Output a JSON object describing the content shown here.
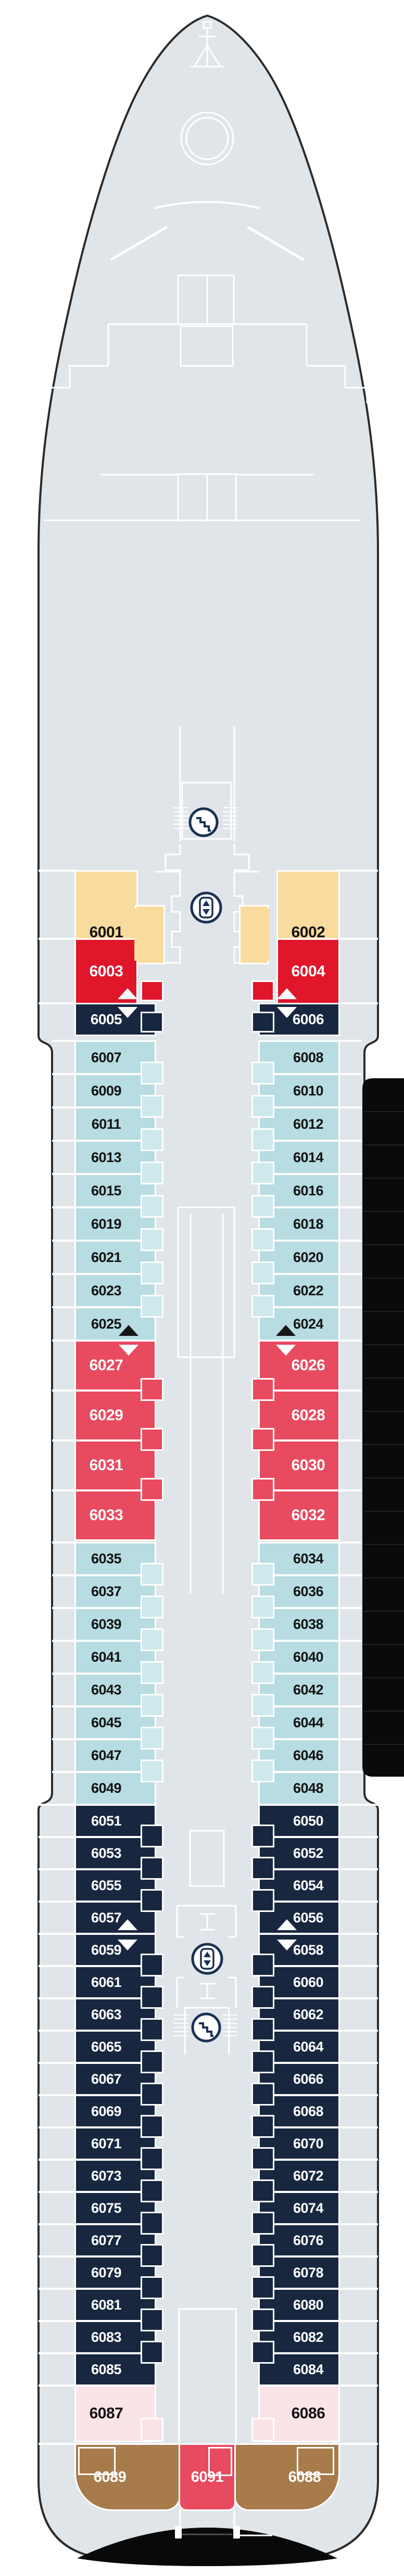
{
  "deck_plan_name": "cruise-ship-deck-plan",
  "colors": {
    "background": "#ffffff",
    "deck": "#e0e5e9",
    "hull_outline": "#2b2b2b",
    "line_art": "#ffffff",
    "lifeboat_band": "#0a0a0a",
    "lifeboat_band_line": "#212121",
    "stern_bulwark": "#090909",
    "icon_navy": "#1b3054",
    "arrow_black": "#161616",
    "arrow_white": "#ffffff"
  },
  "cabin_categories": {
    "yellow": {
      "fill": "#f8db9d",
      "text": "#121212"
    },
    "red": {
      "fill": "#e0162b",
      "text": "#ffffff"
    },
    "rose": {
      "fill": "#e84a5f",
      "text": "#ffffff"
    },
    "blue": {
      "fill": "#b7dce1",
      "text": "#121212",
      "tab_fill": "#cde9ec"
    },
    "navy": {
      "fill": "#18273f",
      "text": "#ffffff"
    },
    "pink": {
      "fill": "#fae4e8",
      "text": "#121212"
    },
    "brown": {
      "fill": "#a87b4b",
      "text": "#ffffff"
    }
  },
  "sections": [
    {
      "id": "forward-suites-yellow",
      "category": "yellow",
      "left": [
        "6001"
      ],
      "right": [
        "6002"
      ]
    },
    {
      "id": "forward-suites-red",
      "category": "red",
      "left": [
        "6003"
      ],
      "right": [
        "6004"
      ]
    },
    {
      "id": "forward-navy",
      "category": "navy",
      "left": [
        "6005"
      ],
      "right": [
        "6006"
      ]
    },
    {
      "id": "forward-oceanview",
      "category": "blue",
      "left": [
        "6007",
        "6009",
        "6011",
        "6013",
        "6015",
        "6019",
        "6021",
        "6023",
        "6025"
      ],
      "right": [
        "6008",
        "6010",
        "6012",
        "6014",
        "6016",
        "6018",
        "6020",
        "6022",
        "6024"
      ]
    },
    {
      "id": "midship-rose",
      "category": "rose",
      "left": [
        "6027",
        "6029",
        "6031",
        "6033"
      ],
      "right": [
        "6026",
        "6028",
        "6030",
        "6032"
      ]
    },
    {
      "id": "midship-oceanview",
      "category": "blue",
      "left": [
        "6035",
        "6037",
        "6039",
        "6041",
        "6043",
        "6045",
        "6047",
        "6049"
      ],
      "right": [
        "6034",
        "6036",
        "6038",
        "6040",
        "6042",
        "6044",
        "6046",
        "6048"
      ]
    },
    {
      "id": "aft-navy",
      "category": "navy",
      "left": [
        "6051",
        "6053",
        "6055",
        "6057",
        "6059",
        "6061",
        "6063",
        "6065",
        "6067",
        "6069",
        "6071",
        "6073",
        "6075",
        "6077",
        "6079",
        "6081",
        "6083",
        "6085"
      ],
      "right": [
        "6050",
        "6052",
        "6054",
        "6056",
        "6058",
        "6060",
        "6062",
        "6064",
        "6066",
        "6068",
        "6070",
        "6072",
        "6074",
        "6076",
        "6078",
        "6080",
        "6082",
        "6084"
      ]
    },
    {
      "id": "aft-pink",
      "category": "pink",
      "left": [
        "6087"
      ],
      "right": [
        "6086"
      ]
    },
    {
      "id": "stern",
      "category": "brown",
      "left": [
        "6089"
      ],
      "right": [
        "6088"
      ],
      "center": [
        "6091"
      ],
      "center_category": "rose"
    }
  ],
  "connecting_arrows": [
    {
      "cabins": [
        "6003",
        "6005"
      ],
      "side": "port"
    },
    {
      "cabins": [
        "6004",
        "6006"
      ],
      "side": "starboard"
    },
    {
      "cabins": [
        "6025",
        "6027"
      ],
      "side": "port"
    },
    {
      "cabins": [
        "6024",
        "6026"
      ],
      "side": "starboard"
    },
    {
      "cabins": [
        "6057",
        "6059"
      ],
      "side": "port"
    },
    {
      "cabins": [
        "6056",
        "6058"
      ],
      "side": "starboard"
    }
  ],
  "icons": [
    {
      "name": "mast-icon",
      "location": "bow"
    },
    {
      "name": "stairs-icon",
      "location": "forward-stair-lobby"
    },
    {
      "name": "elevator-icon",
      "location": "forward-elevator-lobby"
    },
    {
      "name": "elevator-icon",
      "location": "aft-elevator-lobby"
    },
    {
      "name": "stairs-icon",
      "location": "aft-stair-lobby"
    }
  ]
}
